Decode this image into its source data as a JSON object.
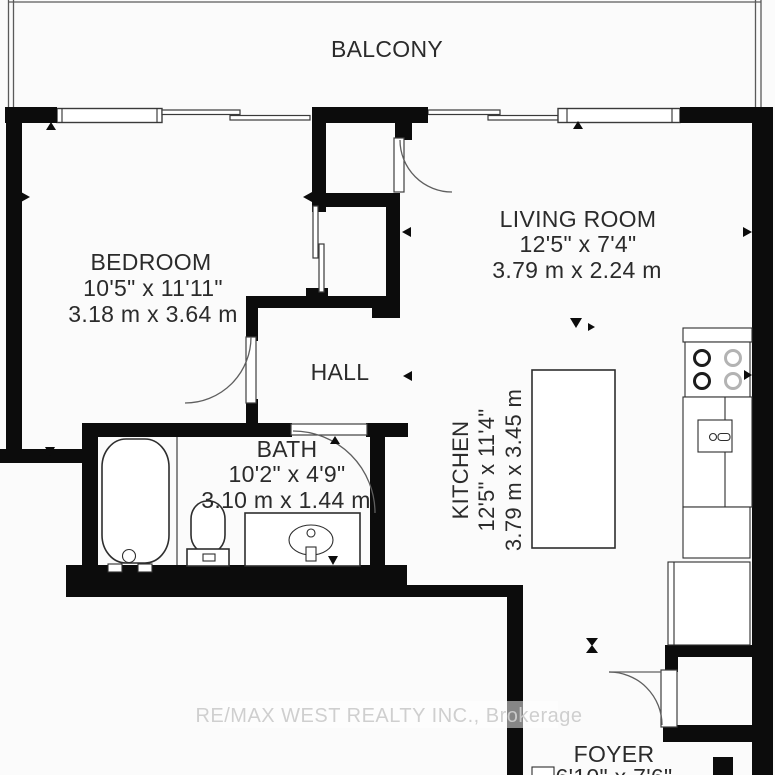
{
  "balcony": {
    "label": "BALCONY"
  },
  "rooms": {
    "bedroom": {
      "name": "BEDROOM",
      "imperial": "10'5\" x 11'11\"",
      "metric": "3.18 m x 3.64 m"
    },
    "living_room": {
      "name": "LIVING ROOM",
      "imperial": "12'5\" x 7'4\"",
      "metric": "3.79 m x 2.24 m"
    },
    "hall": {
      "name": "HALL"
    },
    "bath": {
      "name": "BATH",
      "imperial": "10'2\" x 4'9\"",
      "metric": "3.10 m x 1.44 m"
    },
    "kitchen": {
      "name": "KITCHEN",
      "imperial": "12'5\" x 11'4\"",
      "metric": "3.79 m x 3.45 m"
    },
    "foyer": {
      "name": "FOYER",
      "imperial": "6'10\" x 7'6\""
    }
  },
  "watermark": "RE/MAX WEST REALTY INC., Brokerage",
  "colors": {
    "wall": "#0c0c0c",
    "thin_line": "#4a4a4a",
    "label_text": "#2b2b2b",
    "watermark_text": "#cdcdcd",
    "background": "#fbfbfb"
  }
}
